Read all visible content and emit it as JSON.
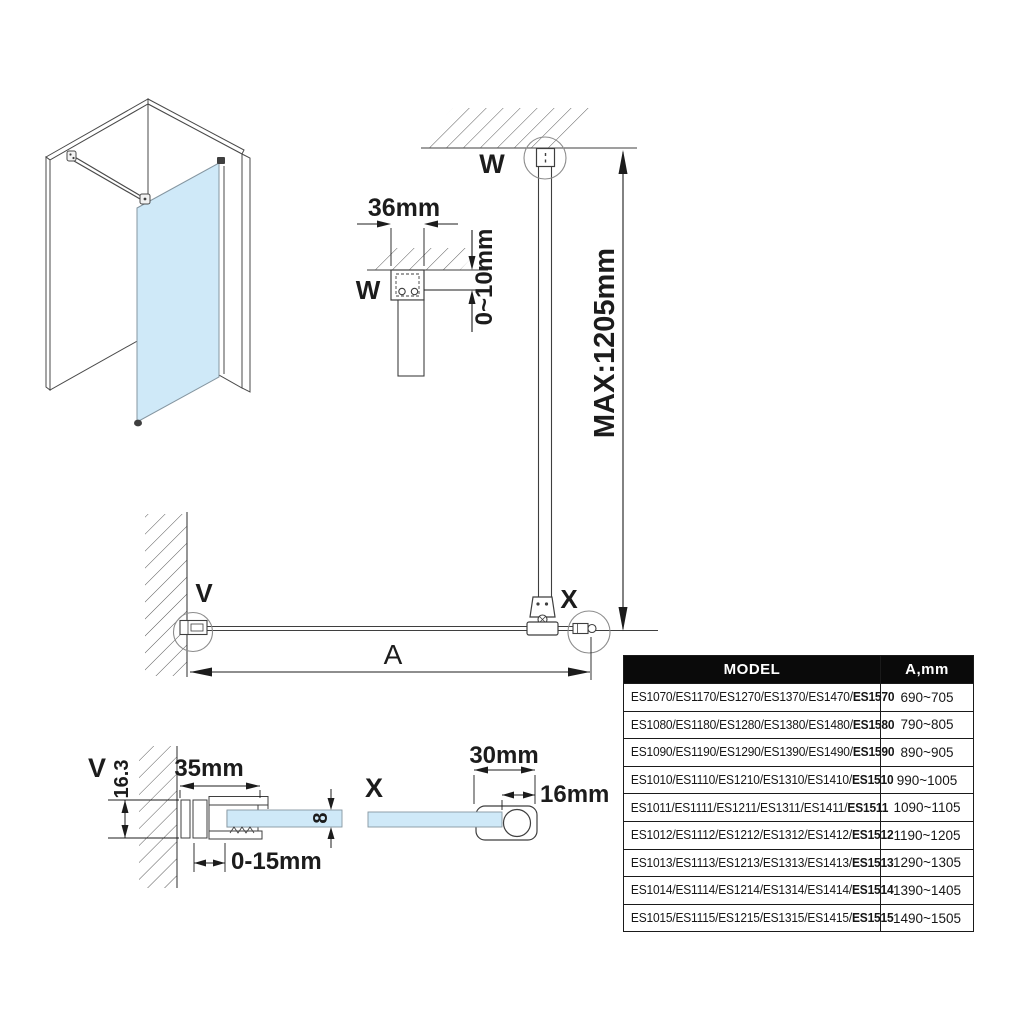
{
  "colors": {
    "glass": "#cfe9f8",
    "line": "#3f3f3f",
    "dimension": "#1c1c1c",
    "table_header_bg": "#0a0a0a",
    "table_header_text": "#ffffff"
  },
  "views": {
    "labels": {
      "w_plan": "W",
      "w_detail": "W",
      "v_plan": "V",
      "x_plan": "X",
      "v_detail": "V",
      "x_detail": "X"
    },
    "dimensions": {
      "panel_width": "A",
      "bar_max_length": "MAX:1205mm",
      "ceiling_bracket_width": "36mm",
      "ceiling_gap": "0~10mm",
      "wall_profile_width": "35mm",
      "wall_profile_depth": "16.3",
      "profile_adjustment": "0-15mm",
      "glass_thickness": "8",
      "bar_clamp_length": "30mm",
      "bar_clamp_depth": "16mm"
    }
  },
  "table": {
    "headers": {
      "model": "MODEL",
      "a": "A,mm"
    },
    "rows": [
      {
        "models": "ES1070/ES1170/ES1270/ES1370/ES1470/",
        "last": "ES1570",
        "a": "690~705"
      },
      {
        "models": "ES1080/ES1180/ES1280/ES1380/ES1480/",
        "last": "ES1580",
        "a": "790~805"
      },
      {
        "models": "ES1090/ES1190/ES1290/ES1390/ES1490/",
        "last": "ES1590",
        "a": "890~905"
      },
      {
        "models": "ES1010/ES1110/ES1210/ES1310/ES1410/",
        "last": "ES1510",
        "a": "990~1005"
      },
      {
        "models": "ES1011/ES1111/ES1211/ES1311/ES1411/",
        "last": "ES1511",
        "a": "1090~1105"
      },
      {
        "models": "ES1012/ES1112/ES1212/ES1312/ES1412/",
        "last": "ES1512",
        "a": "1190~1205"
      },
      {
        "models": "ES1013/ES1113/ES1213/ES1313/ES1413/",
        "last": "ES1513",
        "a": "1290~1305"
      },
      {
        "models": "ES1014/ES1114/ES1214/ES1314/ES1414/",
        "last": "ES1514",
        "a": "1390~1405"
      },
      {
        "models": "ES1015/ES1115/ES1215/ES1315/ES1415/",
        "last": "ES1515",
        "a": "1490~1505"
      }
    ]
  }
}
